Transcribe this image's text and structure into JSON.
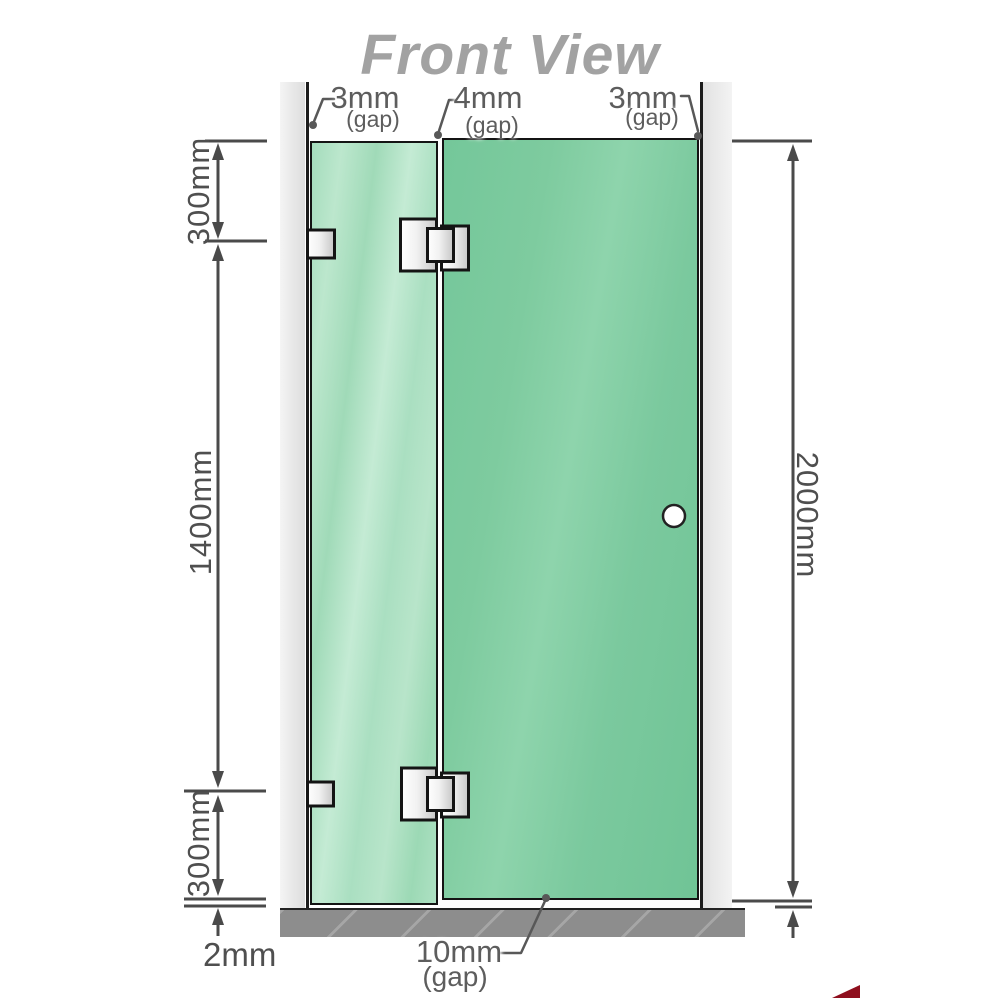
{
  "title": "Front View",
  "annotations": {
    "gap_top_left": {
      "value": "3mm",
      "qualifier": "(gap)"
    },
    "gap_top_middle": {
      "value": "4mm",
      "qualifier": "(gap)"
    },
    "gap_top_right": {
      "value": "3mm",
      "qualifier": "(gap)"
    },
    "gap_bottom_door": {
      "value": "10mm",
      "qualifier": "(gap)"
    }
  },
  "dims": {
    "left_top": "300mm",
    "left_middle": "1400mm",
    "left_bottom": "300mm",
    "floor_gap": "2mm",
    "right_total": "2000mm"
  },
  "colors": {
    "glass_fixed_panel": "#a9dfc0",
    "glass_door_panel": "#7cc9a0",
    "wall": "#e9e9e9",
    "floor": "#8d8d8d",
    "dimension_lines": "#4a4a4a",
    "title_text": "#a2a2a2",
    "logo_sliver": "#8f0f1e"
  }
}
